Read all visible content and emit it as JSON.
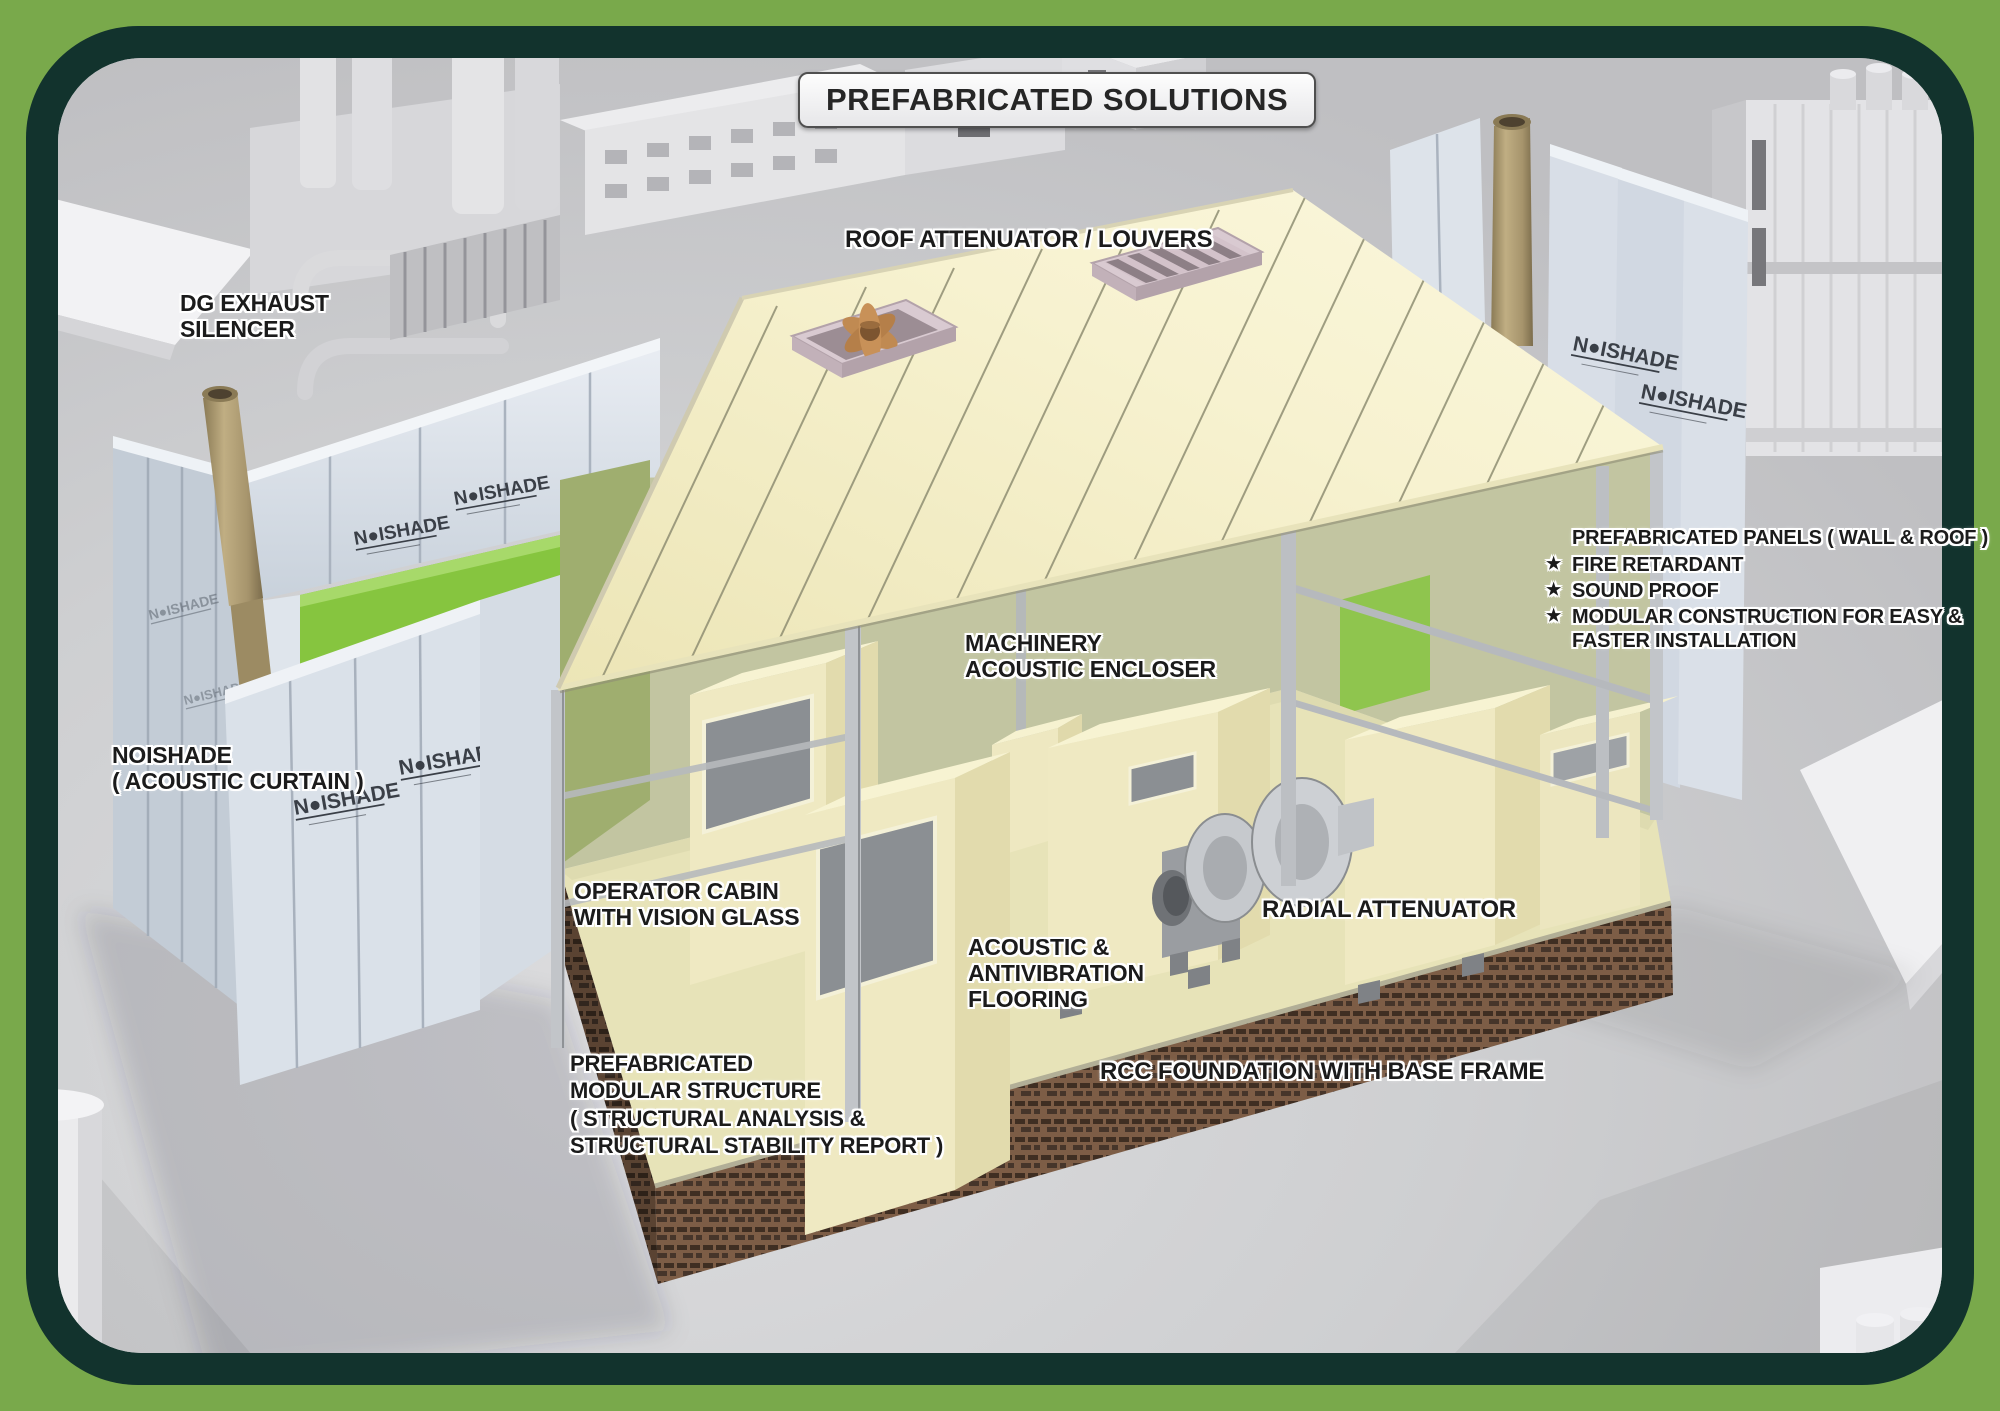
{
  "title": "PREFABRICATED SOLUTIONS",
  "brand": {
    "logo_text": "N●ISHADE"
  },
  "callouts": {
    "roof_attenuator": "ROOF ATTENUATOR / LOUVERS",
    "dg_exhaust_silencer": "DG EXHAUST\nSILENCER",
    "machinery_enclosure": "MACHINERY\nACOUSTIC ENCLOSER",
    "noishade_curtain": "NOISHADE\n( ACOUSTIC CURTAIN )",
    "operator_cabin": "OPERATOR CABIN\nWITH VISION GLASS",
    "flooring": "ACOUSTIC &\nANTIVIBRATION\nFLOORING",
    "radial_attenuator": "RADIAL ATTENUATOR",
    "modular_structure": "PREFABRICATED\nMODULAR STRUCTURE\n( STRUCTURAL ANALYSIS &\nSTRUCTURAL STABILITY REPORT )",
    "rcc_foundation": "RCC FOUNDATION WITH BASE FRAME"
  },
  "panels": {
    "heading": "PREFABRICATED PANELS ( WALL & ROOF )",
    "bullet": "★",
    "items": [
      "FIRE RETARDANT",
      "SOUND PROOF",
      "MODULAR CONSTRUCTION FOR EASY &\nFASTER INSTALLATION"
    ]
  },
  "colors": {
    "frame_green": "#79a94b",
    "frame_dark": "#12332d",
    "accent_green": "#86c53f",
    "roof_cream": "#f6f1cd",
    "curtain_blue": "#d8dee7",
    "brick_brown": "#7d5d46"
  }
}
